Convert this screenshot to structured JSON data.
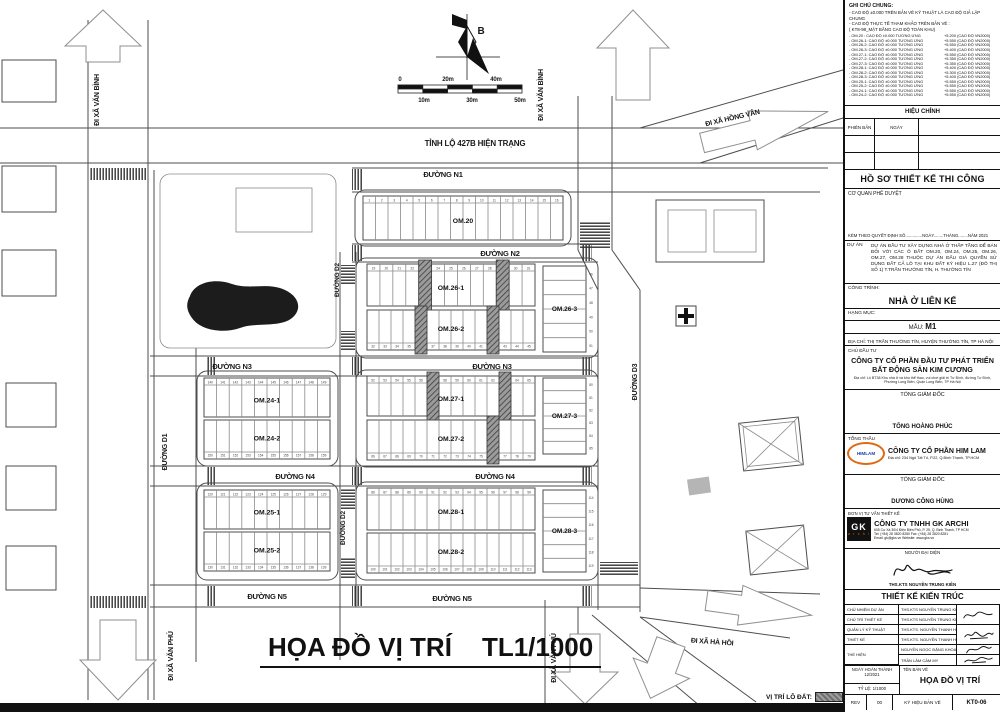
{
  "map": {
    "title": "HỌA ĐỒ VỊ TRÍ",
    "scale": "TL1/1000",
    "legend_label": "VỊ TRÍ LÔ ĐẤT:",
    "north_label": "B",
    "labels": [
      {
        "t": "TỈNH LỘ 427B HIỆN TRẠNG",
        "x": 475,
        "y": 146,
        "s": 8
      },
      {
        "t": "ĐƯỜNG N1",
        "x": 443,
        "y": 177,
        "s": 7.5
      },
      {
        "t": "ĐƯỜNG N2",
        "x": 500,
        "y": 256,
        "s": 7.5
      },
      {
        "t": "ĐƯỜNG N3",
        "x": 232,
        "y": 369,
        "s": 7.5
      },
      {
        "t": "ĐƯỜNG N3",
        "x": 492,
        "y": 369,
        "s": 7.5
      },
      {
        "t": "ĐƯỜNG N4",
        "x": 295,
        "y": 479,
        "s": 7.5
      },
      {
        "t": "ĐƯỜNG N4",
        "x": 495,
        "y": 479,
        "s": 7.5
      },
      {
        "t": "ĐƯỜNG N5",
        "x": 267,
        "y": 599,
        "s": 7.5
      },
      {
        "t": "ĐƯỜNG N5",
        "x": 452,
        "y": 601,
        "s": 7.5
      },
      {
        "t": "ĐƯỜNG D1",
        "x": 167,
        "y": 452,
        "r": -90,
        "s": 7
      },
      {
        "t": "ĐƯỜNG D2",
        "x": 339,
        "y": 280,
        "r": -90,
        "s": 6.5
      },
      {
        "t": "ĐƯỜNG D2",
        "x": 345,
        "y": 528,
        "r": -90,
        "s": 6.5
      },
      {
        "t": "ĐƯỜNG D3",
        "x": 637,
        "y": 382,
        "r": -90,
        "s": 7
      },
      {
        "t": "ĐI XÃ VĂN BÌNH",
        "x": 99,
        "y": 100,
        "r": -90,
        "s": 7
      },
      {
        "t": "ĐI XÃ VĂN BÌNH",
        "x": 543,
        "y": 95,
        "r": -90,
        "s": 7
      },
      {
        "t": "ĐI XÃ HỒNG VÂN",
        "x": 733,
        "y": 120,
        "r": -13,
        "s": 7
      },
      {
        "t": "ĐI XÃ HÀ HỒI",
        "x": 712,
        "y": 644,
        "r": 4,
        "s": 7
      },
      {
        "t": "ĐI XÃ VĂN PHÚ",
        "x": 173,
        "y": 656,
        "r": -90,
        "s": 7
      },
      {
        "t": "ĐI XÃ VĂN PHÚ",
        "x": 556,
        "y": 658,
        "r": -90,
        "s": 7
      },
      {
        "t": "B",
        "x": 481,
        "y": 34,
        "s": 10
      },
      {
        "t": "0",
        "x": 400,
        "y": 81,
        "s": 6
      },
      {
        "t": "20m",
        "x": 448,
        "y": 81,
        "s": 6
      },
      {
        "t": "40m",
        "x": 496,
        "y": 81,
        "s": 6
      },
      {
        "t": "10m",
        "x": 424,
        "y": 102,
        "s": 6
      },
      {
        "t": "30m",
        "x": 472,
        "y": 102,
        "s": 6
      },
      {
        "t": "50m",
        "x": 520,
        "y": 102,
        "s": 6
      }
    ],
    "groups": [
      [
        355,
        190,
        216,
        56
      ],
      [
        356,
        258,
        242,
        100
      ],
      [
        356,
        370,
        242,
        97
      ],
      [
        356,
        482,
        242,
        98
      ],
      [
        197,
        371,
        141,
        95
      ],
      [
        197,
        483,
        141,
        97
      ]
    ],
    "rows": [
      {
        "label": "OM.20",
        "x": 363,
        "y": 196,
        "w": 200,
        "h": 44,
        "lots": 16,
        "start": 1,
        "num": "top",
        "hatched": []
      },
      {
        "label": "OM.26-1",
        "x": 367,
        "y": 264,
        "w": 168,
        "h": 42,
        "lots": 13,
        "start": 19,
        "num": "top",
        "hatched": [
          23,
          29
        ]
      },
      {
        "label": "OM.26-2",
        "x": 367,
        "y": 310,
        "w": 168,
        "h": 40,
        "lots": 14,
        "start": 32,
        "num": "bottom",
        "hatched": [
          36,
          42
        ]
      },
      {
        "label": "OM.27-1",
        "x": 367,
        "y": 376,
        "w": 168,
        "h": 40,
        "lots": 14,
        "start": 52,
        "num": "top",
        "hatched": [
          57,
          63
        ]
      },
      {
        "label": "OM.27-2",
        "x": 367,
        "y": 420,
        "w": 168,
        "h": 40,
        "lots": 14,
        "start": 66,
        "num": "bottom",
        "hatched": [
          76
        ]
      },
      {
        "label": "OM.28-1",
        "x": 367,
        "y": 488,
        "w": 168,
        "h": 42,
        "lots": 14,
        "start": 86,
        "num": "top",
        "hatched": []
      },
      {
        "label": "OM.28-2",
        "x": 367,
        "y": 533,
        "w": 168,
        "h": 40,
        "lots": 14,
        "start": 100,
        "num": "bottom",
        "hatched": []
      },
      {
        "label": "OM.24-1",
        "x": 204,
        "y": 378,
        "w": 126,
        "h": 39,
        "lots": 10,
        "start": 140,
        "num": "top",
        "hatched": []
      },
      {
        "label": "OM.24-2",
        "x": 204,
        "y": 420,
        "w": 126,
        "h": 39,
        "lots": 10,
        "start": 150,
        "num": "bottom",
        "hatched": []
      },
      {
        "label": "OM.25-1",
        "x": 204,
        "y": 490,
        "w": 126,
        "h": 39,
        "lots": 10,
        "start": 120,
        "num": "top",
        "hatched": []
      },
      {
        "label": "OM.25-2",
        "x": 204,
        "y": 532,
        "w": 126,
        "h": 39,
        "lots": 10,
        "start": 130,
        "num": "bottom",
        "hatched": []
      }
    ],
    "cols": [
      {
        "label": "OM.26-3",
        "x": 543,
        "y": 266,
        "w": 43,
        "h": 86,
        "lots": 6,
        "start": 46
      },
      {
        "label": "OM.27-3",
        "x": 543,
        "y": 378,
        "w": 43,
        "h": 76,
        "lots": 6,
        "start": 80
      },
      {
        "label": "OM.28-3",
        "x": 543,
        "y": 490,
        "w": 43,
        "h": 82,
        "lots": 6,
        "start": 114
      }
    ]
  },
  "notes": {
    "title": "GHI CHÚ CHUNG:",
    "intro": [
      "- CAO ĐỘ ±0.000 TRÊN BẢN VẼ KỸ THUẬT LÀ CAO ĐỘ GIẢ LẬP CHUNG",
      "- CAO ĐỘ THỰC TẾ THAM KHẢO TRÊN BẢN VẼ :",
      "( KT8-98_MẶT BẰNG CAO ĐỘ TOÀN KHU)"
    ],
    "elevations": [
      {
        "l": "- OM.20   : CAO ĐỘ ±0.000 TƯƠNG ỨNG",
        "r": "+5.200 (CAO ĐỘ VN2000)"
      },
      {
        "l": "- OM.26-1: CAO ĐỘ ±0.000 TƯƠNG ỨNG",
        "r": "+5.550 (CAO ĐỘ VN2000)"
      },
      {
        "l": "- OM.26-2: CAO ĐỘ ±0.000 TƯƠNG ỨNG",
        "r": "+5.550 (CAO ĐỘ VN2000)"
      },
      {
        "l": "- OM.26-3: CAO ĐỘ ±0.000 TƯƠNG ỨNG",
        "r": "+5.400 (CAO ĐỘ VN2000)"
      },
      {
        "l": "- OM.27-1: CAO ĐỘ ±0.000 TƯƠNG ỨNG",
        "r": "+5.550 (CAO ĐỘ VN2000)"
      },
      {
        "l": "- OM.27-2: CAO ĐỘ ±0.000 TƯƠNG ỨNG",
        "r": "+5.350 (CAO ĐỘ VN2000)"
      },
      {
        "l": "- OM.27-3: CAO ĐỘ ±0.000 TƯƠNG ỨNG",
        "r": "+5.350 (CAO ĐỘ VN2000)"
      },
      {
        "l": "- OM.28-1: CAO ĐỘ ±0.000 TƯƠNG ỨNG",
        "r": "+5.400 (CAO ĐỘ VN2000)"
      },
      {
        "l": "- OM.28-2: CAO ĐỘ ±0.000 TƯƠNG ỨNG",
        "r": "+5.300 (CAO ĐỘ VN2000)"
      },
      {
        "l": "- OM.28-3: CAO ĐỘ ±0.000 TƯƠNG ỨNG",
        "r": "+5.400 (CAO ĐỘ VN2000)"
      },
      {
        "l": "- OM.25-1: CAO ĐỘ ±0.000 TƯƠNG ỨNG",
        "r": "+5.550 (CAO ĐỘ VN2000)"
      },
      {
        "l": "- OM.25-2: CAO ĐỘ ±0.000 TƯƠNG ỨNG",
        "r": "+5.550 (CAO ĐỘ VN2000)"
      },
      {
        "l": "- OM.24-1: CAO ĐỘ ±0.000 TƯƠNG ỨNG",
        "r": "+5.550 (CAO ĐỘ VN2000)"
      },
      {
        "l": "- OM.24-2: CAO ĐỘ ±0.000 TƯƠNG ỨNG",
        "r": "+5.550 (CAO ĐỘ VN2000)"
      }
    ]
  },
  "titleblock": {
    "hieu_chinh": "HIỆU CHỈNH",
    "phien_ban": "PHIÊN BẢN",
    "ngay": "NGÀY",
    "ho_so": "HỒ SƠ THIẾT KẾ THI CÔNG",
    "co_quan": "CƠ QUAN PHÊ DUYỆT",
    "kem_theo": "KÈM THEO QUYẾT ĐỊNH SỐ..............NGÀY........THÁNG........NĂM 2021",
    "du_an_label": "DỰ ÁN",
    "du_an": "DỰ ÁN ĐẦU TƯ XÂY DỰNG NHÀ Ở THẤP TẦNG ĐỂ BÁN ĐỐI VỚI CÁC Ô ĐẤT OM.20, OM.24, OM.25, OM.26, OM.27, OM.28 THUỘC DỰ ÁN ĐẤU GIÁ QUYỀN SỬ DỤNG ĐẤT CẢ LÔ TẠI KHU ĐẤT KÝ HIỆU L.27 (ĐÔ THỊ SỐ 1) T.TRẤN THƯỜNG TÍN, H. THƯỜNG TÍN",
    "cong_trinh_label": "CÔNG TRÌNH:",
    "cong_trinh": "NHÀ Ở LIÊN KẾ",
    "hang_muc_label": "HẠNG MỤC:",
    "mau_label": "MẪU:",
    "mau": "M1",
    "dia_chi": "ĐỊA CHỈ:  THỊ TRẤN THƯỜNG TÍN, HUYỆN THƯỜNG TÍN, TP HÀ NỘI",
    "chu_dau_tu_label": "CHỦ ĐẦU TƯ",
    "chu_dau_tu": "CÔNG TY CỔ PHẦN ĐẦU TƯ PHÁT TRIỂN BẤT ĐỘNG SẢN KIM CƯƠNG",
    "chu_dau_tu_addr": "Địa chỉ: Lô BT38 Khu nhà ở và khu thể thao, vui chơi giải trí Tư Đình, đường Tư Đình, Phường Long Biên, Quận Long Biên, TP Hà Nội",
    "tong_giam_doc": "TỔNG GIÁM ĐỐC",
    "tgd1_name": "TỐNG HOÀNG PHÚC",
    "tong_thau_label": "TỔNG THẦU",
    "himlam_logo": "HIMLAM",
    "tong_thau": "CÔNG TY CỔ PHẦN HIM LAM",
    "tong_thau_addr": "Địa chỉ: 234 Ngô Tất Tố, P.22, Q.Bình Thạnh, TP.HCM",
    "tgd2_label": "TỔNG GIÁM ĐỐC",
    "tgd2_name": "DƯƠNG CÔNG HÙNG",
    "don_vi_label": "ĐƠN VỊ TƯ VẤN THIẾT KẾ",
    "gk_logo_1": "GK",
    "gk_logo_2": "a r c h i",
    "gk_name": "CÔNG TY TNHH GK ARCHI",
    "gk_addr1": "605 Cư Xá 30/4 Điện Biên Phủ, P. 25, Q. Bình Thạnh, TP HCM",
    "gk_addr2": "Tel: (+84) 28 3820 8280        Fax: (+84) 28 3820 8281",
    "gk_addr3": "Email: gk@gks.vn        Website: www.gks.vn",
    "nguoi_dai_dien": "NGƯỜI ĐẠI DIỆN",
    "rep_name": "THS.KTS NGUYỄN TRUNG KIÊN",
    "tkkt": "THIẾT KẾ KIẾN TRÚC",
    "staff": [
      {
        "role": "CHỦ NHIỆM DỰ ÁN",
        "name": "THS.KTS NGUYỄN TRUNG KIÊN"
      },
      {
        "role": "CHỦ TRÌ THIẾT KẾ",
        "name": "THS.KTS NGUYỄN TRUNG KIÊN"
      },
      {
        "role": "QUẢN LÝ KỸ THUẬT",
        "name": "THS.KTS. NGUYỄN THANH HOÀN ÂN"
      },
      {
        "role": "THIẾT KẾ",
        "name": "THS.KTS. NGUYỄN THANH HOÀN ÂN"
      },
      {
        "role": "THỂ HIỆN",
        "name": "NGUYỄN NGỌC ĐẶNG KHOA"
      },
      {
        "role": "",
        "name": "TRẦN LÂM CẨM MY"
      }
    ],
    "ngay_hoan_thanh_label": "NGÀY HOÀN THÀNH",
    "ngay_hoan_thanh": "12/2021",
    "ty_le": "TỶ LỆ:  1/1000",
    "ten_ban_ve_label": "TÊN BẢN VẼ",
    "ten_ban_ve": "HỌA ĐỒ VỊ TRÍ",
    "rev_label": "REV",
    "rev": "00",
    "ky_hieu_label": "KÝ HIỆU BẢN VẼ",
    "ky_hieu": "KT0-06"
  }
}
